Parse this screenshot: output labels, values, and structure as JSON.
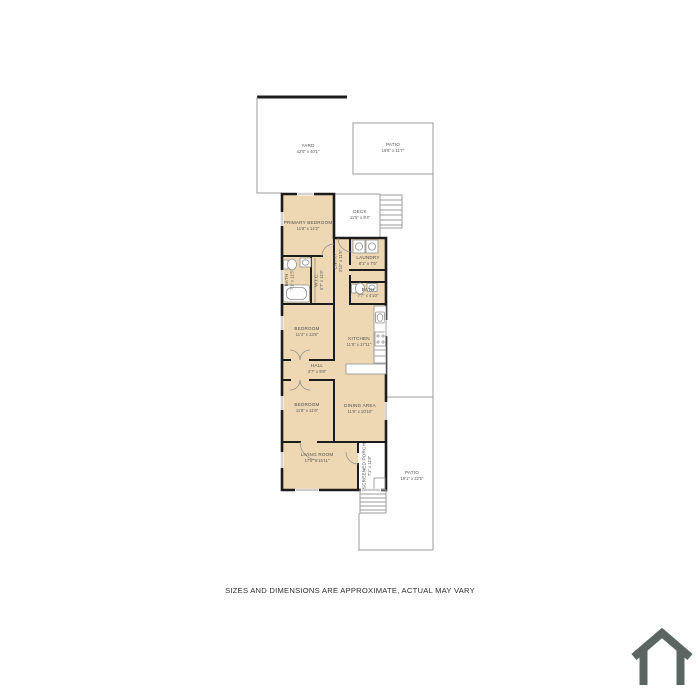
{
  "page": {
    "background": "#ffffff",
    "disclaimer": "SIZES AND DIMENSIONS ARE APPROXIMATE, ACTUAL MAY VARY"
  },
  "colors": {
    "room_fill": "#edd8b3",
    "wall": "#1c1c1c",
    "outdoor_line": "#9b9b9b",
    "label_text": "#4d4d4d",
    "footer_text": "#2e2e2e",
    "logo": "#5b6662"
  },
  "floor_plan": {
    "outdoor": [
      {
        "name": "YARD",
        "dims": "42'0\" x 40'1\""
      },
      {
        "name": "PATIO",
        "dims": "19'8\" x 11'7\""
      },
      {
        "name": "DECK",
        "dims": "11'5\" x 9'4\""
      },
      {
        "name": "SCREENED PORCH",
        "dims": "7'1\" x 11'8\""
      },
      {
        "name": "PATIO",
        "dims": "19'1\" x 22'5\""
      }
    ],
    "rooms": [
      {
        "name": "PRIMARY BEDROOM",
        "dims": "11'8\" x 14'2\""
      },
      {
        "name": "LAUNDRY",
        "dims": "8'1\" x 7'5\""
      },
      {
        "name": "ENTRY",
        "dims": "3'10\" x 11'5\""
      },
      {
        "name": "BATH",
        "dims": "7'1\" x 11'5\""
      },
      {
        "name": "W.I.C.",
        "dims": "5'7\" x 11'5\""
      },
      {
        "name": "BATH",
        "dims": "7'7\" x 4'10\""
      },
      {
        "name": "BEDROOM",
        "dims": "11'4\" x 13'8\""
      },
      {
        "name": "KITCHEN",
        "dims": "11'8\" x 17'11\""
      },
      {
        "name": "HALL",
        "dims": "3'7\" x 9'8\""
      },
      {
        "name": "BEDROOM",
        "dims": "11'8\" x 11'6\""
      },
      {
        "name": "DINING AREA",
        "dims": "11'8\" x 10'10\""
      },
      {
        "name": "LIVING ROOM",
        "dims": "17'5\" x 15'11\""
      }
    ],
    "icons": {
      "brand": "house-outline-icon",
      "fixtures": [
        "washer-dryer",
        "bathtub",
        "toilet",
        "sink",
        "stove",
        "fridge",
        "stairs"
      ]
    }
  }
}
